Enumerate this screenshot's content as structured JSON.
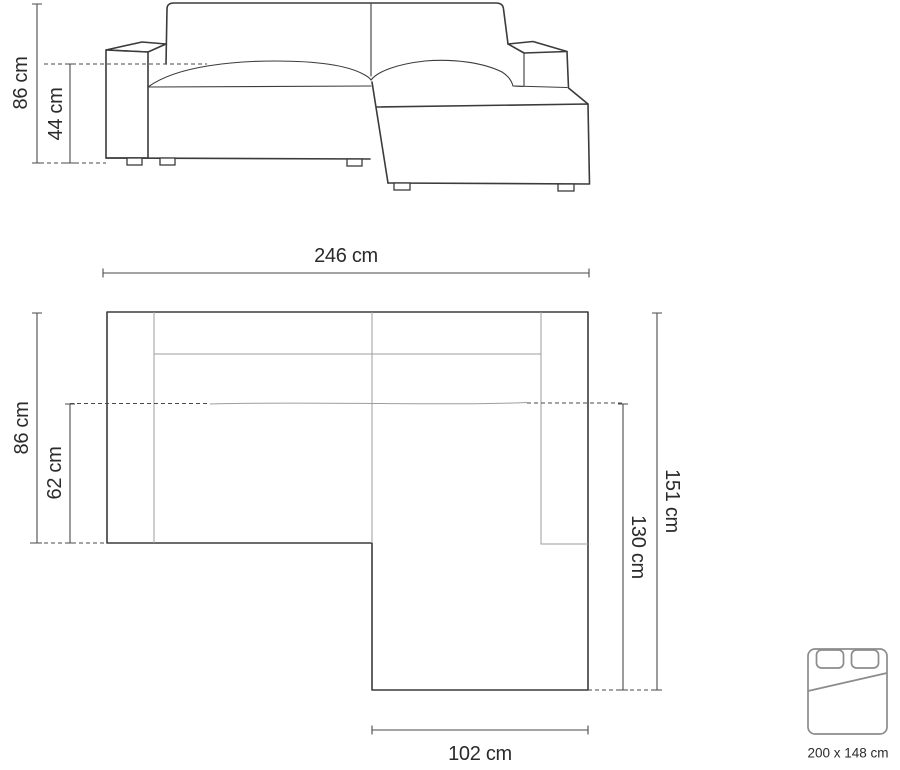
{
  "front_view": {
    "height_label": "86 cm",
    "seat_height_label": "44 cm"
  },
  "top_view": {
    "width_label": "246 cm",
    "depth_label": "86 cm",
    "seat_depth_label": "62 cm",
    "total_length_label": "151 cm",
    "chaise_length_label": "130 cm",
    "chaise_width_label": "102 cm"
  },
  "sleeping_area": {
    "size_label": "200 x 148 cm",
    "icon": "bed-top-view-icon"
  },
  "colors": {
    "background": "#ffffff",
    "outline": "#3b3b3b",
    "seam": "#9e9e9e",
    "dimension_line": "#4a4a4a",
    "label_text": "#2b2b2b",
    "icon_stroke": "#8c8c8c"
  }
}
